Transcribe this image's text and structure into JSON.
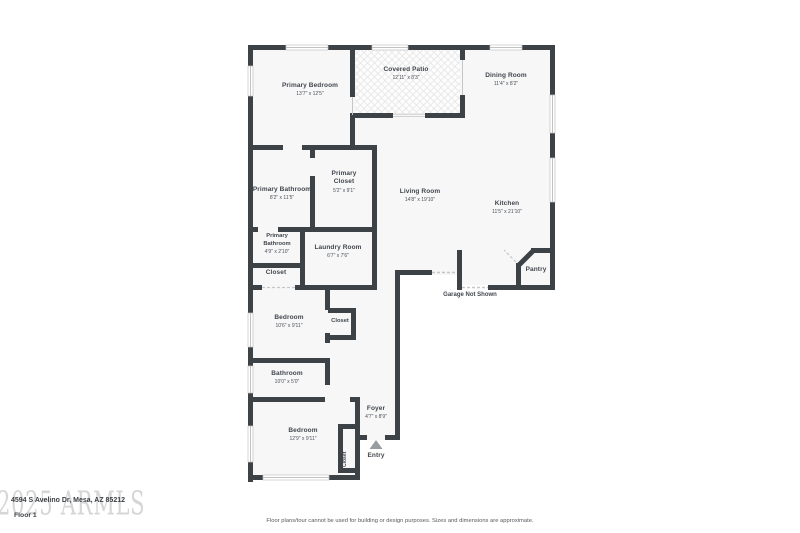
{
  "colors": {
    "wall": "#3d4247",
    "floor": "#f7f7f8",
    "patio": "#fdfdfd",
    "patio_hatch": "#e6e6e6",
    "label_text": "#41464c",
    "watermark": "#cdcdcd"
  },
  "watermark": {
    "text": "2025 ARMLS"
  },
  "footer": {
    "address": "4594 S Avelino Dr, Mesa, AZ 85212",
    "floor_label": "Floor 1",
    "disclaimer": "Floor plans/tour cannot be used for building or design purposes. Sizes and dimensions are approximate."
  },
  "rooms": {
    "primary_bedroom": {
      "name": "Primary Bedroom",
      "dims": "13'7\" x 12'5\""
    },
    "covered_patio": {
      "name": "Covered Patio",
      "dims": "12'11\" x 8'3\""
    },
    "dining_room": {
      "name": "Dining Room",
      "dims": "11'4\" x 8'2\""
    },
    "primary_bathroom": {
      "name": "Primary Bathroom",
      "dims": "8'2\" x 11'5\""
    },
    "primary_closet": {
      "name": "Primary Closet",
      "dims": "5'2\" x 9'1\""
    },
    "living_room": {
      "name": "Living Room",
      "dims": "14'8\" x 19'10\""
    },
    "kitchen": {
      "name": "Kitchen",
      "dims": "11'5\" x 21'10\""
    },
    "primary_bathroom_2": {
      "name": "Primary Bathroom",
      "dims": "4'9\" x 2'10\""
    },
    "laundry_room": {
      "name": "Laundry Room",
      "dims": "6'7\" x 7'6\""
    },
    "hall_closet": {
      "name": "Closet"
    },
    "pantry": {
      "name": "Pantry"
    },
    "garage_note": {
      "name": "Garage Not Shown"
    },
    "bedroom_1": {
      "name": "Bedroom",
      "dims": "10'6\" x 9'11\""
    },
    "bedroom_1_closet": {
      "name": "Closet"
    },
    "bathroom": {
      "name": "Bathroom",
      "dims": "10'0\" x 5'0\""
    },
    "bedroom_2": {
      "name": "Bedroom",
      "dims": "12'9\" x 9'11\""
    },
    "bedroom_2_closet": {
      "name": "Closet"
    },
    "foyer": {
      "name": "Foyer",
      "dims": "4'7\" x 8'9\""
    },
    "entry": {
      "name": "Entry"
    }
  }
}
